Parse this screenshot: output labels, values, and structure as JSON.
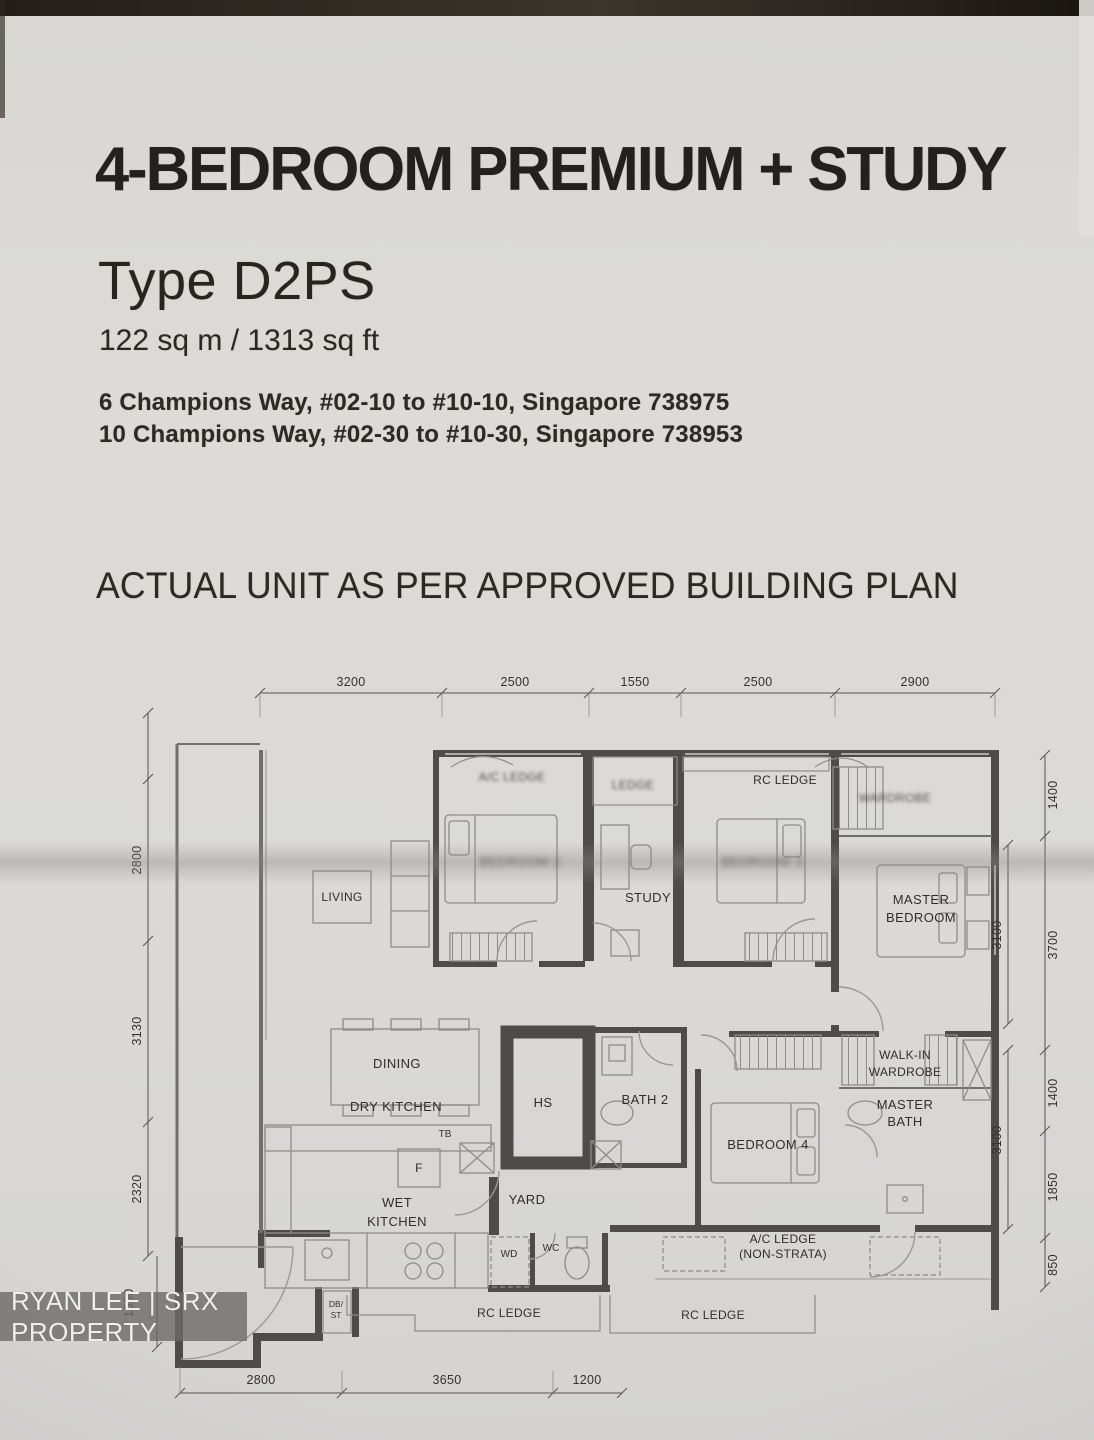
{
  "header": {
    "title": "4-BEDROOM PREMIUM + STUDY",
    "unit_type": "Type D2PS",
    "area": "122 sq m / 1313 sq ft",
    "address_line_1": "6 Champions Way, #02-10 to #10-10, Singapore 738975",
    "address_line_2": "10 Champions Way, #02-30 to #10-30, Singapore 738953",
    "plan_note": "ACTUAL UNIT AS PER APPROVED BUILDING PLAN"
  },
  "watermark": "RYAN LEE | SRX PROPERTY",
  "plan": {
    "labels": {
      "living": "LIVING",
      "dining": "DINING",
      "dry_kitchen": "DRY KITCHEN",
      "wet_kitchen_l1": "WET",
      "wet_kitchen_l2": "KITCHEN",
      "yard": "YARD",
      "study": "STUDY",
      "bedroom2": "BEDROOM 2",
      "bedroom3": "BEDROOM 3",
      "master_l1": "MASTER",
      "master_l2": "BEDROOM",
      "walkin_l1": "WALK-IN",
      "walkin_l2": "WARDROBE",
      "bedroom4": "BEDROOM 4",
      "master_bath_l1": "MASTER",
      "master_bath_l2": "BATH",
      "bath2": "BATH 2",
      "hs": "HS",
      "wd": "WD",
      "wc": "WC",
      "tb": "TB",
      "fridge": "F",
      "db_l1": "DB/",
      "db_l2": "ST",
      "ac_ledge_l1": "A/C LEDGE",
      "ac_ledge_l2": "(NON-STRATA)",
      "rc_ledge_top": "RC LEDGE",
      "rc_ledge_bottom_1": "RC LEDGE",
      "rc_ledge_bottom_2": "RC LEDGE",
      "ledge_top": "LEDGE",
      "ac_ledge_top": "A/C LEDGE",
      "wardrobe_top": "WARDROBE"
    },
    "dims": {
      "top": [
        "3200",
        "2500",
        "1550",
        "2500",
        "2900"
      ],
      "left": [
        "2800",
        "3130",
        "2320",
        "1550"
      ],
      "right_outer": [
        "1400",
        "3700",
        "1400",
        "1850",
        "850"
      ],
      "right_inner": [
        "3100",
        "3100"
      ],
      "bottom": [
        "2800",
        "3650",
        "1200"
      ]
    }
  }
}
